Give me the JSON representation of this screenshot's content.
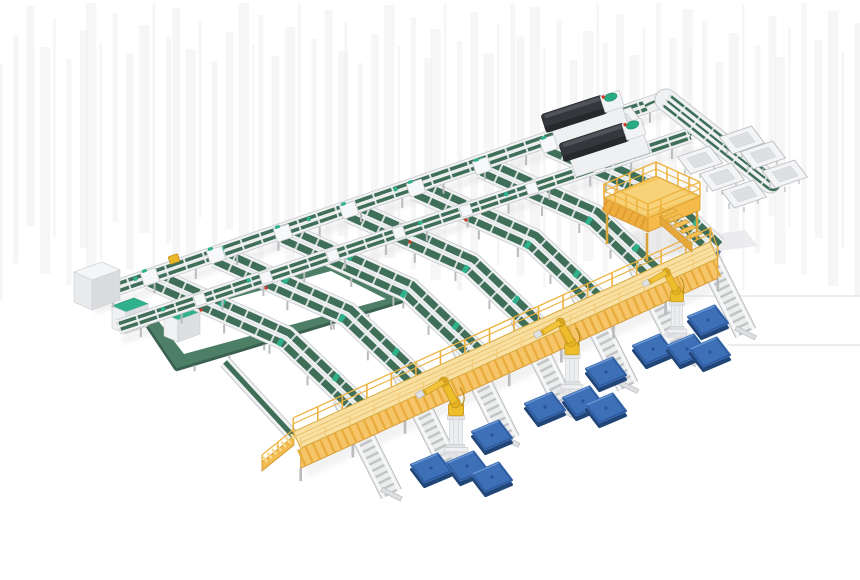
{
  "meta": {
    "description": "3D isometric render of an automated parcel sorting and palletizing facility",
    "render_type": "product-render",
    "visible_text": ""
  },
  "palette": {
    "background": "#ffffff",
    "belt_green": "#3f6f58",
    "loop_green": "#4d7e66",
    "loop_green_dark": "#3a6150",
    "teal_cap": "#2fb18c",
    "frame_white": "#f0f1f3",
    "frame_edge": "#c6c8cb",
    "roller_gray": "#c2c4c7",
    "leg_gray": "#b9bbbe",
    "walkway_side": "#f6c569",
    "walkway_deck": "#f8dfa2",
    "walkway_rail": "#edb23f",
    "platform_yellow": "#f6c75e",
    "platform_wall": "#eeae3f",
    "robot_yellow": "#edbd2c",
    "robot_shade": "#c0921b",
    "pallet_blue": "#3d70b6",
    "pallet_blue_dark": "#224578",
    "machine_dark": "#34373b",
    "cabinet_white": "#f5f6f8",
    "accent_red": "#cc3726",
    "accent_blue": "#3a6fb5",
    "parcel_yellow": "#e8b62a"
  },
  "scene": {
    "main_sorter": {
      "label": "dual main sorter lines",
      "line_a": [
        [
          90,
          297
        ],
        [
          668,
          98
        ]
      ],
      "line_a2": [
        [
          118,
          327
        ],
        [
          690,
          135
        ]
      ],
      "width_a": 15,
      "width_a2": 14
    },
    "corner_curves": [
      "M645,106 Q662,96 673,103 Q680,109 677,117",
      "M690,135 Q702,127 708,132"
    ],
    "takeaway": {
      "label": "takeaway line with tray stations",
      "center": [
        [
          666,
          100
        ],
        [
          770,
          182
        ]
      ],
      "loop_path": "M662.3,104.7 L766.3,186.7 Q774,193 778,187 Q782,181 773.7,177.3 L669.7,95.3"
    },
    "branches": {
      "label": "sorting branch chutes",
      "count": 7,
      "tops": [
        [
          150,
          277
        ],
        [
          216,
          255
        ],
        [
          283,
          233
        ],
        [
          349,
          210
        ],
        [
          416,
          188
        ],
        [
          482,
          166
        ],
        [
          549,
          144
        ]
      ],
      "scales": [
        0.97,
        0.937,
        0.9,
        0.87,
        0.835,
        0.8,
        0.765
      ],
      "mid_vec": [
        140,
        63
      ],
      "end_vec": [
        218,
        137
      ]
    },
    "output_lanes": {
      "label": "roller output lanes under walkway",
      "count": 7,
      "start_off": [
        -18,
        -12
      ],
      "end_off": [
        30,
        84
      ]
    },
    "left_loop": {
      "label": "tote return loop",
      "outer": [
        [
          140,
          316
        ],
        [
          334,
          260
        ],
        [
          408,
          300
        ],
        [
          176,
          370
        ]
      ],
      "inner": [
        [
          157,
          319
        ],
        [
          331,
          271
        ],
        [
          386,
          299
        ],
        [
          184,
          354
        ]
      ]
    },
    "connector": [
      [
        225,
        362
      ],
      [
        293,
        436
      ]
    ],
    "infeed_cabinet": {
      "label": "infeed control cabinet",
      "pos": [
        70,
        262
      ]
    },
    "loop_cabinets": {
      "label": "loop drive cabinets",
      "positions": [
        [
          112,
          306
        ],
        [
          164,
          314
        ]
      ]
    },
    "label_machines": {
      "label": "scanner / labeling machines",
      "count": 2,
      "poses": [
        {
          "x": 545,
          "y": 128,
          "len": 64
        },
        {
          "x": 563,
          "y": 157,
          "len": 68
        }
      ]
    },
    "maintenance_platform": {
      "label": "yellow maintenance platform with stairs",
      "deck": [
        [
          604,
          198
        ],
        [
          656,
          176
        ],
        [
          700,
          196
        ],
        [
          648,
          218
        ]
      ],
      "wall_h": 14,
      "rail_h": 14,
      "stairs_from": [
        660,
        214
      ],
      "stair_steps": 5
    },
    "walkway": {
      "label": "yellow elevated conveyor walkway",
      "from": [
        297,
        440
      ],
      "to": [
        714,
        250
      ],
      "deck_half_w": 9,
      "side_h": 20,
      "ramp": {
        "top": [
          294,
          436
        ],
        "bottom": [
          262,
          462
        ]
      }
    },
    "robots": {
      "label": "palletizing robot arms",
      "count": 3,
      "poses": [
        {
          "x": 456,
          "y": 452,
          "s": 0.95
        },
        {
          "x": 572,
          "y": 389,
          "s": 0.9
        },
        {
          "x": 677,
          "y": 333,
          "s": 0.82
        }
      ]
    },
    "pallets": {
      "label": "blue pallet stacks",
      "count": 12,
      "centers": [
        [
          492,
          435
        ],
        [
          467,
          466
        ],
        [
          492,
          477
        ],
        [
          431,
          468
        ],
        [
          545,
          407
        ],
        [
          583,
          401
        ],
        [
          606,
          408
        ],
        [
          606,
          372
        ],
        [
          653,
          349
        ],
        [
          687,
          349
        ],
        [
          710,
          352
        ],
        [
          708,
          320
        ]
      ]
    },
    "trays": {
      "label": "white tray stations",
      "lower": [
        [
          700,
          160
        ],
        [
          722,
          177
        ],
        [
          744,
          194
        ]
      ],
      "upper": [
        [
          742,
          140
        ],
        [
          763,
          155
        ],
        [
          785,
          174
        ]
      ],
      "infeed": [
        [
          592,
          110
        ],
        [
          621,
          121
        ]
      ]
    },
    "parcel": {
      "pos": [
        174,
        259
      ]
    },
    "red_dots": [
      [
        201,
        310
      ],
      [
        266,
        288
      ],
      [
        410,
        242
      ],
      [
        466,
        220
      ],
      [
        597,
        113
      ],
      [
        620,
        132
      ]
    ],
    "artifacts": {
      "h_lines": [
        [
          618,
          296,
          860
        ],
        [
          728,
          345,
          860
        ]
      ],
      "gray_patch": [
        [
          668,
          240
        ],
        [
          745,
          230
        ],
        [
          758,
          246
        ],
        [
          680,
          256
        ]
      ]
    }
  }
}
